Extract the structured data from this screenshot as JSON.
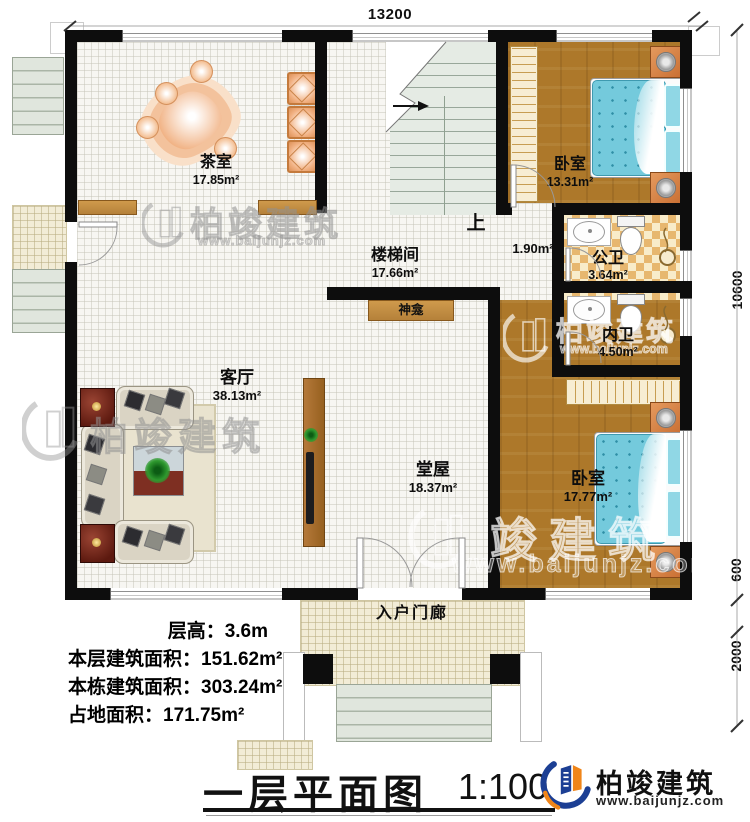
{
  "title": {
    "text": "一层平面图",
    "scale": "1:100"
  },
  "brand": {
    "name": "柏竣建筑",
    "url": "www.baijunjz.com"
  },
  "watermark": {
    "brand": "柏竣建筑",
    "brand_partial": "竣建筑",
    "url": "www.baijunjz.com"
  },
  "dimensions": {
    "top_width": "13200",
    "right_height": "10600",
    "right_step": "600",
    "right_porch": "2000"
  },
  "stats": {
    "floor_height": "层高：3.6m",
    "floor_area": "本层建筑面积：151.62m²",
    "building_area": "本栋建筑面积：303.24m²",
    "footprint": "占地面积：171.75m²"
  },
  "rooms": {
    "tea": {
      "name": "茶室",
      "area": "17.85m²"
    },
    "stairwell": {
      "name": "楼梯间",
      "area": "17.66m²",
      "up": "上"
    },
    "vestibule": {
      "area": "1.90m²"
    },
    "bedroom1": {
      "name": "卧室",
      "area": "13.31m²"
    },
    "public_bath": {
      "name": "公卫",
      "area": "3.64m²"
    },
    "private_bath": {
      "name": "内卫",
      "area": "4.50m²"
    },
    "bedroom2": {
      "name": "卧室",
      "area": "17.77m²"
    },
    "living": {
      "name": "客厅",
      "area": "38.13m²"
    },
    "hall": {
      "name": "堂屋",
      "area": "18.37m²"
    },
    "shrine": {
      "name": "神龛"
    },
    "porch": {
      "name": "入户门廊"
    }
  },
  "colors": {
    "wall": "#0d0d0d",
    "wood_floor": "#ad782a",
    "bed": "#74cadc",
    "checker_tile": "#e7b76f",
    "brand_blue": "#1c3f94",
    "brand_orange": "#f08519"
  }
}
